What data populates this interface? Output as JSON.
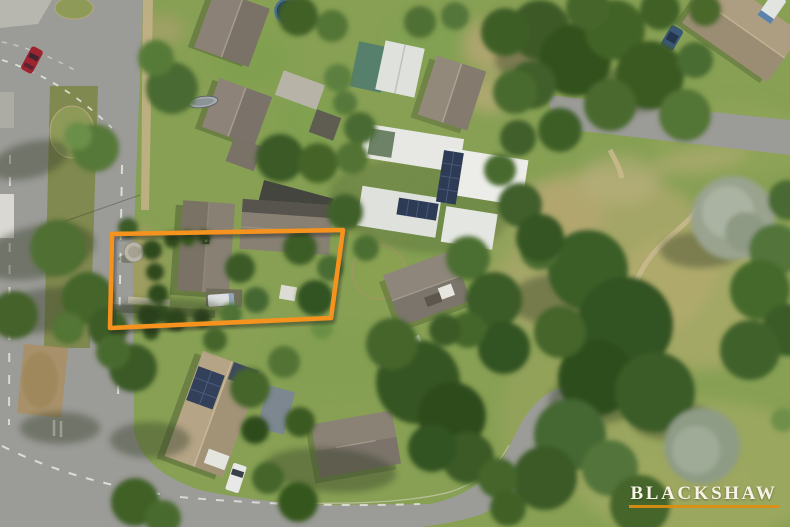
{
  "scene": {
    "type": "aerial-drone-photograph",
    "description": "Top-down aerial photo of a suburban block: an orange outline highlights one residential lot beside a tree-lined street; neighbouring houses have grey, tan and white roofs, some with solar panels; roads with white dashed markings run along the left and bottom; a parkland of large green and silver-grey trees with sandy walking paths fills the right side.",
    "property_boundary": {
      "shape": "quadrilateral",
      "stroke_color": "#F6921E",
      "stroke_width": 4.6,
      "points_flat": [
        112,
        234,
        343,
        230,
        331,
        318,
        110,
        328
      ]
    },
    "notable_objects": [
      "red car on road",
      "blue trampoline",
      "solar panel roofs",
      "round water tank",
      "white ute in driveway",
      "silver gum trees",
      "park walking path"
    ]
  },
  "watermark": {
    "brand": "BLACKSHAW"
  },
  "colors": {
    "boundary_orange": "#F6921E",
    "watermark_text": "#F7F3E8",
    "watermark_underline": "#DD8E10",
    "road_gray": "#9B9B97",
    "lawn_green": "#87A054",
    "park_olive": "#ABA76B"
  }
}
